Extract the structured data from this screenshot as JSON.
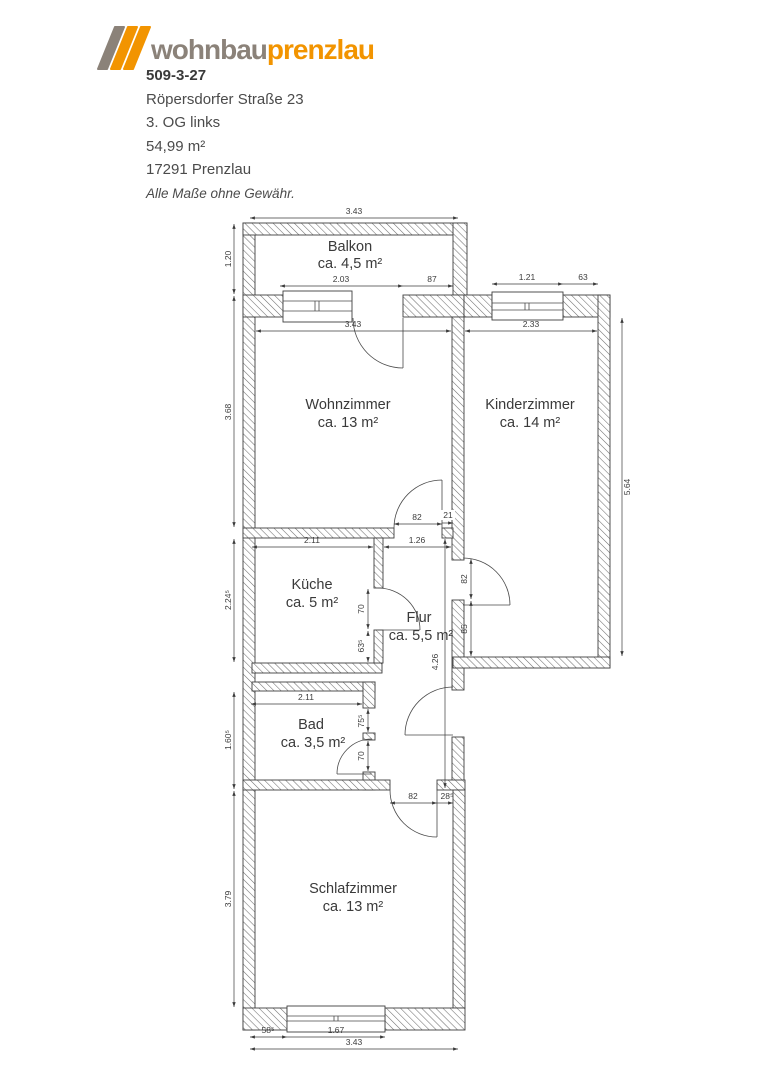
{
  "header": {
    "logo": {
      "word1": "wohnbau",
      "word2": "prenzlau",
      "gray": "#8b8279",
      "orange": "#f29400"
    },
    "object_id": "509-3-27",
    "address": "Röpersdorfer Straße 23",
    "floor": "3. OG links",
    "area": "54,99 m²",
    "city": "17291 Prenzlau",
    "disclaimer": "Alle Maße ohne Gewähr."
  },
  "floorplan": {
    "rooms": [
      {
        "name": "Balkon",
        "area": "ca. 4,5 m²"
      },
      {
        "name": "Wohnzimmer",
        "area": "ca. 13 m²"
      },
      {
        "name": "Kinderzimmer",
        "area": "ca. 14 m²"
      },
      {
        "name": "Küche",
        "area": "ca. 5 m²"
      },
      {
        "name": "Flur",
        "area": "ca. 5,5 m²"
      },
      {
        "name": "Bad",
        "area": "ca. 3,5 m²"
      },
      {
        "name": "Schlafzimmer",
        "area": "ca. 13 m²"
      }
    ],
    "dims": {
      "balkon_width": "3.43",
      "balkon_height": "1.20",
      "wz_window": "2.03",
      "wz_window_side": "87",
      "kz_window": "1.21",
      "kz_window_side": "63",
      "wz_width": "3.43",
      "kz_width": "2.33",
      "wz_height": "3.68",
      "kz_height": "5.64",
      "wz_door": "82",
      "wz_door_stub": "21",
      "kueche_width": "2.11",
      "flur_width": "1.26",
      "kueche_height": "2.24⁵",
      "kueche_door": "70",
      "kueche_wall": "63⁵",
      "kz_door": "82",
      "kz_door_below": "85",
      "flur_height": "4.26",
      "bad_width": "2.11",
      "bad_pass": "75⁵",
      "bad_door": "70",
      "bad_height": "1.60⁵",
      "sz_door": "82",
      "sz_door_stub": "28⁵",
      "sz_height": "3.79",
      "sz_window_side": "58⁵",
      "sz_window": "1.67",
      "sz_width": "3.43"
    }
  }
}
